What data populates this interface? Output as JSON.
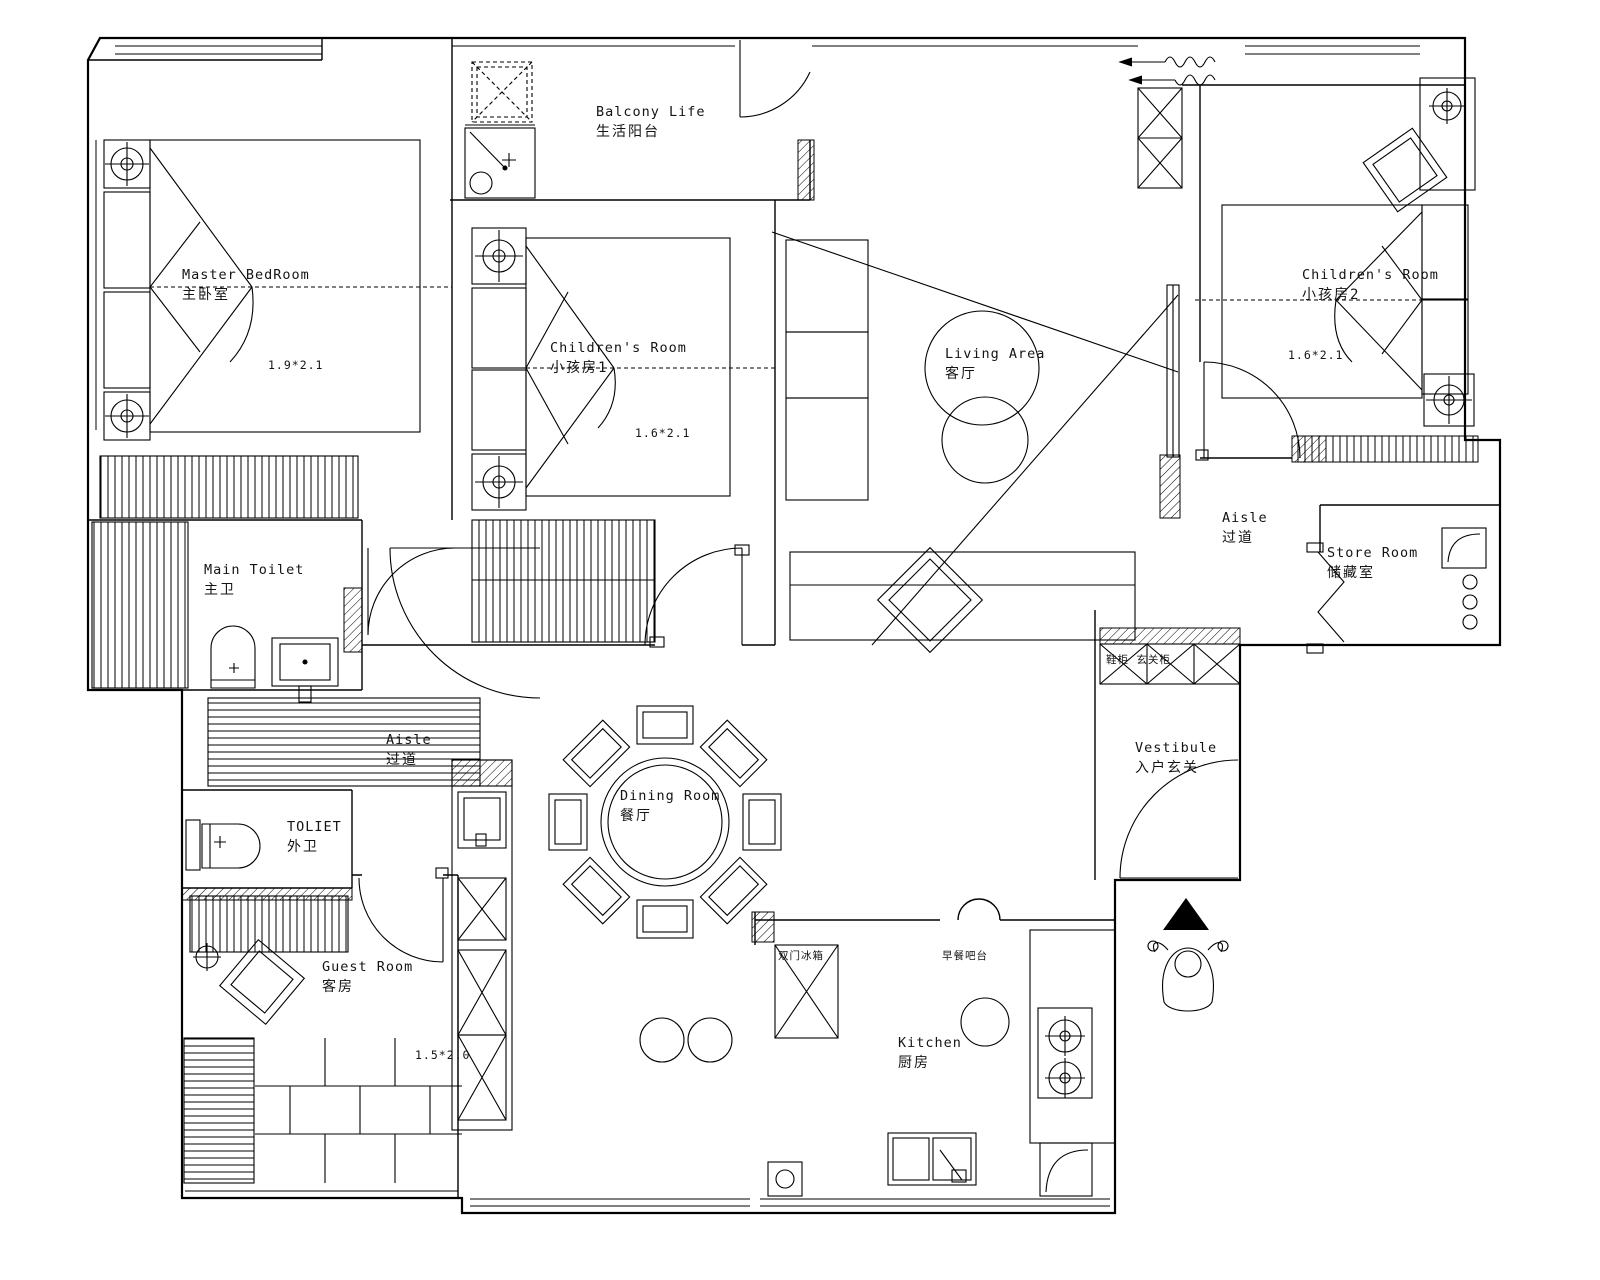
{
  "drawing": {
    "kind": "residential floor plan"
  },
  "colors": {
    "line": "#000000",
    "background": "#ffffff",
    "solid_fill": "#000000"
  },
  "rooms": [
    {
      "id": "master-bedroom",
      "en": "Master BedRoom",
      "zh": "主卧室"
    },
    {
      "id": "balcony",
      "en": "Balcony Life",
      "zh": "生活阳台"
    },
    {
      "id": "childrens-room-1",
      "en": "Children's Room",
      "zh": "小孩房1"
    },
    {
      "id": "living-area",
      "en": "Living Area",
      "zh": "客厅"
    },
    {
      "id": "childrens-room-2",
      "en": "Children's Room",
      "zh": "小孩房2"
    },
    {
      "id": "aisle-east",
      "en": "Aisle",
      "zh": "过道"
    },
    {
      "id": "store-room",
      "en": "Store Room",
      "zh": "储藏室"
    },
    {
      "id": "main-toilet",
      "en": "Main Toilet",
      "zh": "主卫"
    },
    {
      "id": "aisle-west",
      "en": "Aisle",
      "zh": "过道"
    },
    {
      "id": "toilet",
      "en": "TOLIET",
      "zh": "外卫"
    },
    {
      "id": "dining-room",
      "en": "Dining Room",
      "zh": "餐厅"
    },
    {
      "id": "vestibule",
      "en": "Vestibule",
      "zh": "入户玄关"
    },
    {
      "id": "guest-room",
      "en": "Guest Room",
      "zh": "客房"
    },
    {
      "id": "kitchen",
      "en": "Kitchen",
      "zh": "厨房"
    }
  ],
  "dimensions": [
    {
      "room": "master-bedroom",
      "label": "1.9*2.1"
    },
    {
      "room": "childrens-room-1",
      "label": "1.6*2.1"
    },
    {
      "room": "childrens-room-2",
      "label": "1.6*2.1"
    },
    {
      "room": "guest-room",
      "label": "1.5*2.0"
    }
  ],
  "annotations": [
    {
      "id": "fridge",
      "label": "双门冰箱"
    },
    {
      "id": "breakfast-bar",
      "label": "早餐吧台"
    },
    {
      "id": "shoe-cabinet",
      "label": "鞋柜 玄关柜"
    }
  ],
  "icons": [
    "north-triangle-icon",
    "person-figure-icon",
    "ceiling-light-icon",
    "door-swing-icon",
    "wardrobe-x-icon"
  ]
}
